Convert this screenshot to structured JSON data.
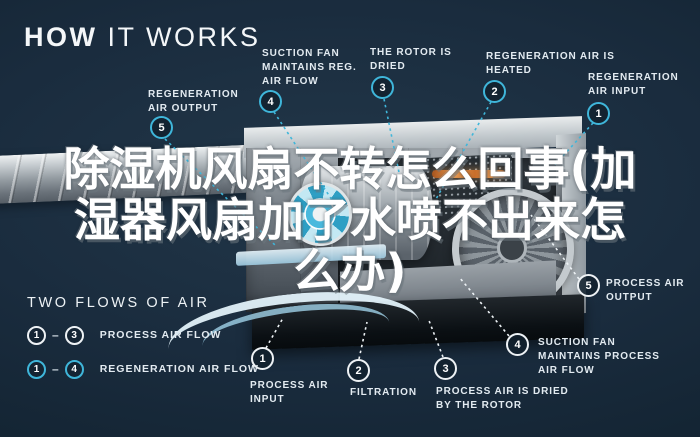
{
  "header": {
    "title_bold": "HOW",
    "title_rest": " IT WORKS"
  },
  "overlay": {
    "line1": "除湿机风扇不转怎么回事(加",
    "line2": "湿器风扇加了水喷不出来怎",
    "line3": "么办)"
  },
  "callouts": {
    "regen_output": {
      "num": "5",
      "label": "REGENERATION AIR OUTPUT"
    },
    "suction_fan_reg": {
      "num": "4",
      "label": "SUCTION FAN MAINTAINS REG. AIR FLOW"
    },
    "rotor_dried": {
      "num": "3",
      "label": "THE ROTOR IS DRIED"
    },
    "regen_heated": {
      "num": "2",
      "label": "REGENERATION AIR IS HEATED"
    },
    "regen_input": {
      "num": "1",
      "label": "REGENERATION AIR INPUT"
    },
    "process_input": {
      "num": "1",
      "label": "PROCESS AIR INPUT"
    },
    "filtration": {
      "num": "2",
      "label": "FILTRATION"
    },
    "process_dried": {
      "num": "3",
      "label": "PROCESS AIR IS DRIED BY THE ROTOR"
    },
    "suction_fan_process": {
      "num": "4",
      "label": "SUCTION FAN MAINTAINS PROCESS AIR FLOW"
    },
    "process_output": {
      "num": "5",
      "label": "PROCESS AIR OUTPUT"
    }
  },
  "legend": {
    "heading": "TWO FLOWS OF AIR",
    "process_row": {
      "from": "1",
      "dash": "–",
      "to": "3",
      "label": "PROCESS AIR FLOW"
    },
    "regen_row": {
      "from": "1",
      "dash": "–",
      "to": "4",
      "label": "REGENERATION AIR FLOW"
    }
  },
  "colors": {
    "background": "#16293A",
    "accent_cyan": "#3FB6DA",
    "label_text": "#E3EBF1",
    "process_ring": "#EEF2F5",
    "heater_orange": "#D97B33"
  }
}
